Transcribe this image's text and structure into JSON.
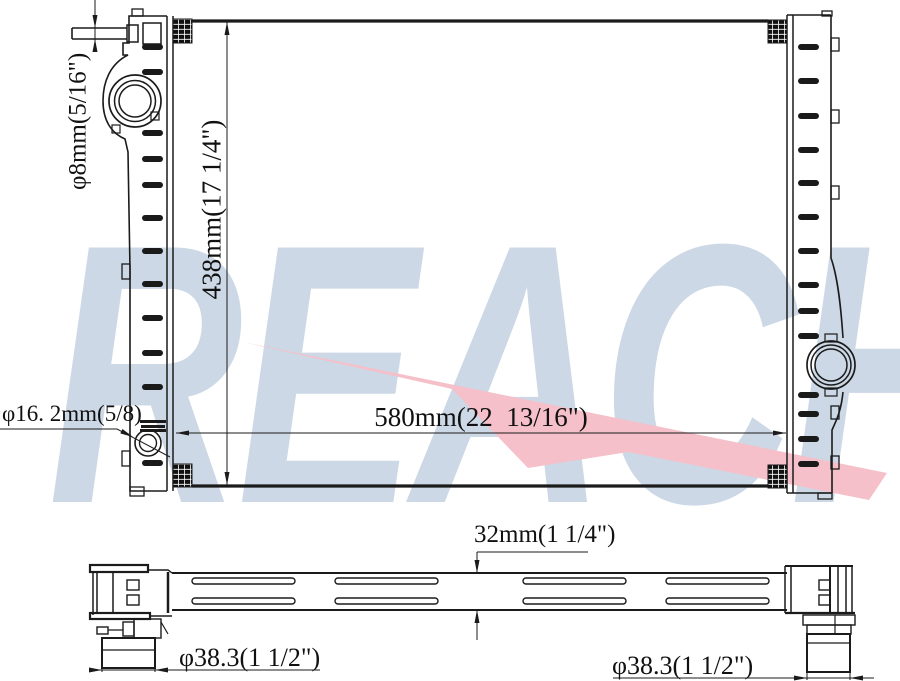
{
  "watermark": {
    "brand": "REACH",
    "letter_color": "#ccd8e5",
    "arrow_color": "#f5c0c9"
  },
  "front_view": {
    "height_dim": "438mm(17 1/4\")",
    "width_dim": "580mm(22  13/16\")",
    "top_pipe_dim": "φ8mm(5/16\")",
    "side_port_dim": "φ16. 2mm(5/8)"
  },
  "side_view": {
    "thickness_dim": "32mm(1 1/4\")",
    "left_pipe_dim": "φ38.3(1 1/2\")",
    "right_pipe_dim": "φ38.3(1 1/2\")"
  }
}
